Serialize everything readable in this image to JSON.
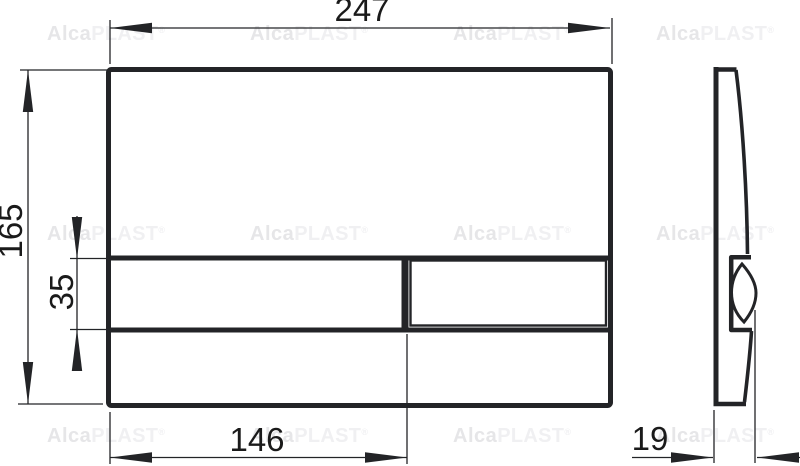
{
  "drawing": {
    "title": "flush-plate dimension drawing",
    "dim_width": "247",
    "dim_height": "165",
    "dim_band_height": "35",
    "dim_button_width": "146",
    "dim_depth": "19"
  },
  "watermark": {
    "brand_bold": "Alca",
    "brand_light": "PLAST",
    "registered": "®"
  },
  "colors": {
    "line": "#232427",
    "dimension_text": "#1a1a1a",
    "watermark_bold": "#e6e6e8",
    "watermark_light": "#f0f0f2",
    "background": "#ffffff"
  }
}
